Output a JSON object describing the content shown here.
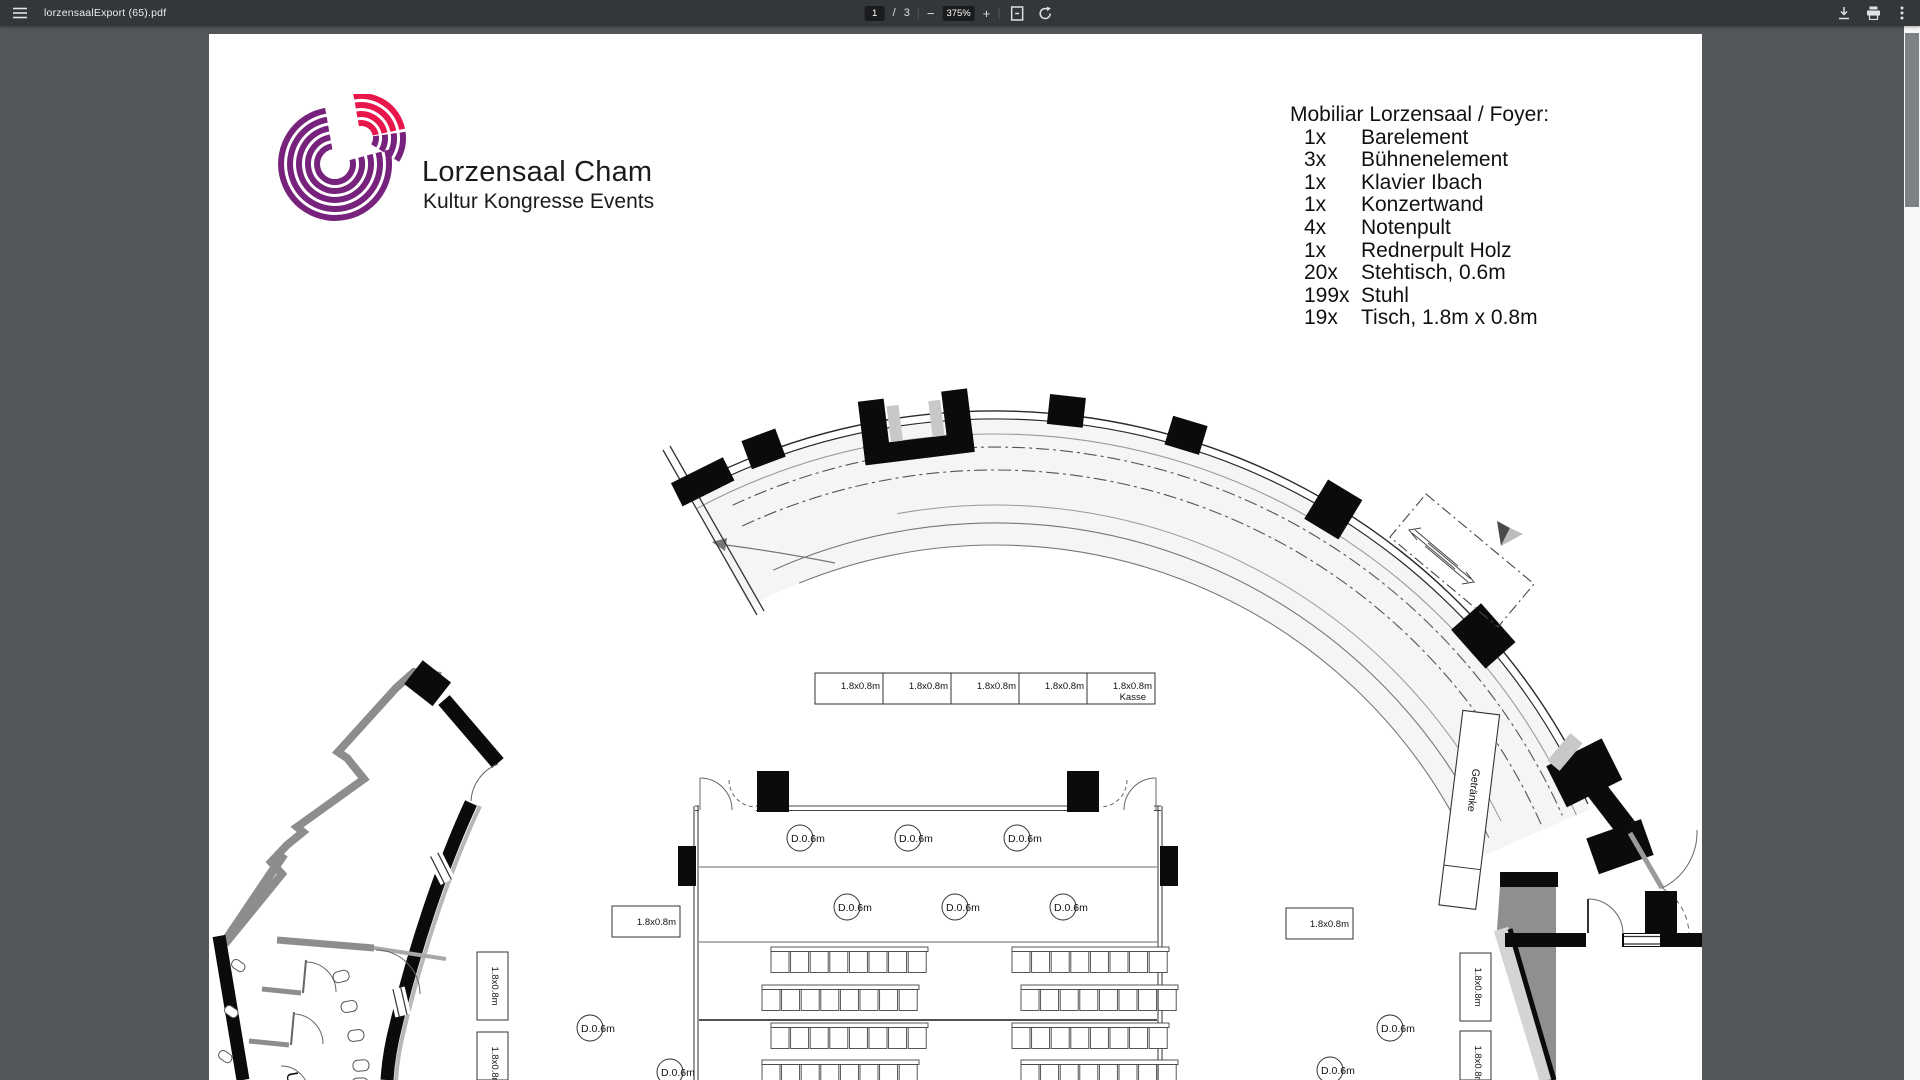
{
  "toolbar": {
    "filename": "lorzensaalExport (65).pdf",
    "page_current": "1",
    "page_divider": "/",
    "page_total": "3",
    "zoom_level": "375%",
    "zoom_out": "−",
    "zoom_in": "+"
  },
  "document": {
    "brand": {
      "title": "Lorzensaal Cham",
      "subtitle": "Kultur Kongresse Events",
      "logo_purple": "#77227d",
      "logo_red": "#e8174b"
    },
    "furniture": {
      "title": "Mobiliar Lorzensaal / Foyer:",
      "items": [
        {
          "qty": "1x",
          "name": "Barelement"
        },
        {
          "qty": "3x",
          "name": "Bühnenelement"
        },
        {
          "qty": "1x",
          "name": "Klavier Ibach"
        },
        {
          "qty": "1x",
          "name": "Konzertwand"
        },
        {
          "qty": "4x",
          "name": "Notenpult"
        },
        {
          "qty": "1x",
          "name": "Rednerpult Holz"
        },
        {
          "qty": "20x",
          "name": "Stehtisch, 0.6m"
        },
        {
          "qty": "199x",
          "name": "Stuhl"
        },
        {
          "qty": "19x",
          "name": "Tisch, 1.8m x 0.8m"
        }
      ]
    },
    "plan_labels": {
      "table": "1.8x0.8m",
      "kasse": "Kasse",
      "stehtisch": "D.0.6m",
      "getraenke": "Getränke",
      "u": "U"
    }
  }
}
